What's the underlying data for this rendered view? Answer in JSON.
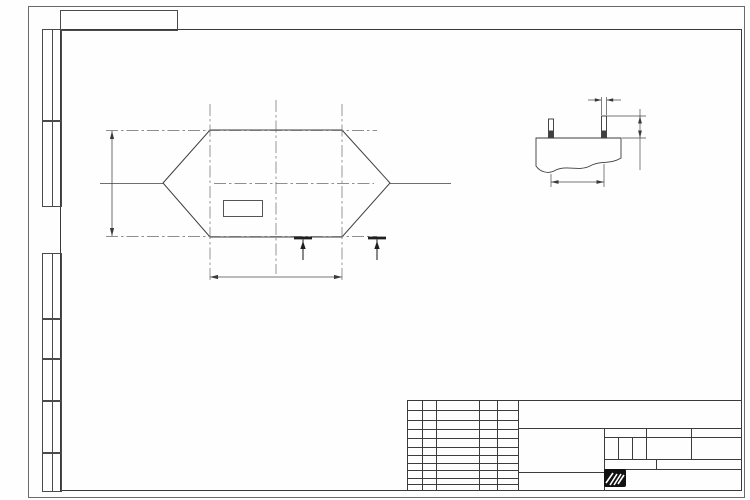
{
  "doc": {
    "number": "КВТУ.026.201.04.000-02 Ф",
    "number_top": "КВТУ.026.201.04.000-02 Ф",
    "format_label": "Формат А3"
  },
  "watermark": {
    "text": "KVZR.RU"
  },
  "margin_columns": [
    "Перв. примен.",
    "Справ. N",
    "Подп. и дата",
    "Инв. N дубл.",
    "Взам. инв. N",
    "Подп. и дата",
    "Инв. N подл."
  ],
  "plan": {
    "axis_label": "Ось симметрии котла",
    "level_mark": "0,000",
    "load_left": "300 кг",
    "load_right": "300 кг",
    "dim_width": "724±2",
    "dim_height": "765±2",
    "section_letter_left": "А",
    "section_letter_right": "А",
    "bolt_groups": {
      "centers": [
        [
          208,
          130
        ],
        [
          342,
          130
        ],
        [
          208,
          237
        ],
        [
          342,
          237
        ]
      ],
      "dx": 14,
      "dy": 13.5
    }
  },
  "section": {
    "title": "А-А (1:5)",
    "bolt_callout": "М16*",
    "dim_protrusion": "50±3",
    "dim_spacing": "160±3"
  },
  "notes": {
    "lines": [
      "1. *Размер для справок.",
      "2. Отклонение от горизонтального уровня верхней поверхности",
      "фундамента не более 10 мм.",
      "3. В случае отсутствия бетонного пола площадку под котел",
      "забетонировать. Расстояние от осей колонн до края бетонной подушки",
      "500 мм.",
      "4. Фундамент под котел разрабатывает проектная организация",
      "по нагрузкам на фундамент."
    ]
  },
  "stamp": {
    "header_cols": [
      "Изм.",
      "Лист",
      "N докум.",
      "Подп.",
      "Дата"
    ],
    "rows": [
      "Разраб.",
      "Пров.",
      "Т.контр",
      "Н.контр",
      "Утв."
    ],
    "title_lines": [
      "Задание на",
      "установку",
      "фундамента"
    ],
    "product_lines": [
      "Котел водогрейный",
      "КВр-0,3 КБД (К)"
    ],
    "lit_header": "Лит.",
    "mass_header": "Масса",
    "scale_header": "Масштаб",
    "lit_value": "И",
    "mass_value": "-",
    "scale_value": "1:10",
    "sheet_label": "Лист",
    "sheets_label": "Листов",
    "sheets_value": "1",
    "logo_text": "KVZR",
    "logo_sub1": "КОТЕЛЬНЫЙ",
    "logo_sub2": "ЗАВОД РЭП"
  }
}
